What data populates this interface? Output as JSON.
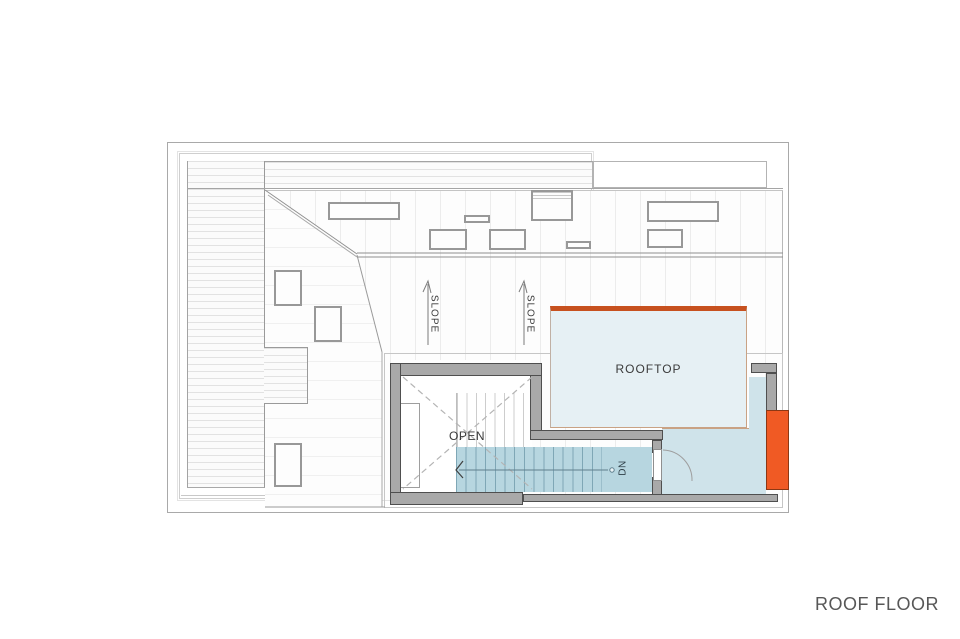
{
  "colors": {
    "orange-accent": "#c7511f",
    "orange-bright": "#f05a24",
    "rooftop-fill": "#e6f0f4",
    "landing-fill": "#cfe3ea",
    "stair-fill": "#b7d6e0",
    "stair-line": "#7fa7b6",
    "wall-fill": "#a9a9a9",
    "wall-edge": "#4f4f4f",
    "tan-line": "#c9a284",
    "plan-line": "#9a9a9a",
    "text": "#3a3a3a"
  },
  "plan": {
    "labels": {
      "rooftop": "ROOFTOP",
      "open": "OPEN",
      "down": "DN",
      "slope_left": "SLOPE",
      "slope_right": "SLOPE"
    }
  },
  "footer": {
    "title": "ROOF FLOOR"
  }
}
